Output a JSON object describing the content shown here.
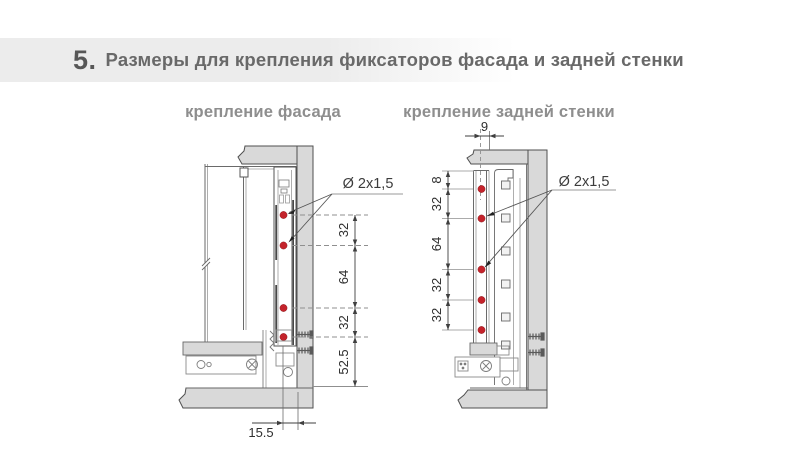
{
  "header": {
    "number": "5.",
    "title": "Размеры для крепления фиксаторов фасада и задней стенки"
  },
  "facade": {
    "label": "крепление фасада",
    "hole_label": "Ø 2x1,5",
    "v_dims": [
      "32",
      "64",
      "32",
      "52.5"
    ],
    "h_dim": "15.5"
  },
  "back": {
    "label": "крепление задней стенки",
    "hole_label": "Ø 2x1,5",
    "v_dims": [
      "8",
      "32",
      "64",
      "32",
      "32"
    ],
    "h_dim": "9"
  },
  "colors": {
    "panel_fill": "#d9d9d9",
    "outline": "#4f4f4f",
    "hole_red": "#c4232b",
    "banner_gray": "#ececec",
    "dim_text": "#2e2e2e",
    "label_gray": "#8e8e8e"
  }
}
